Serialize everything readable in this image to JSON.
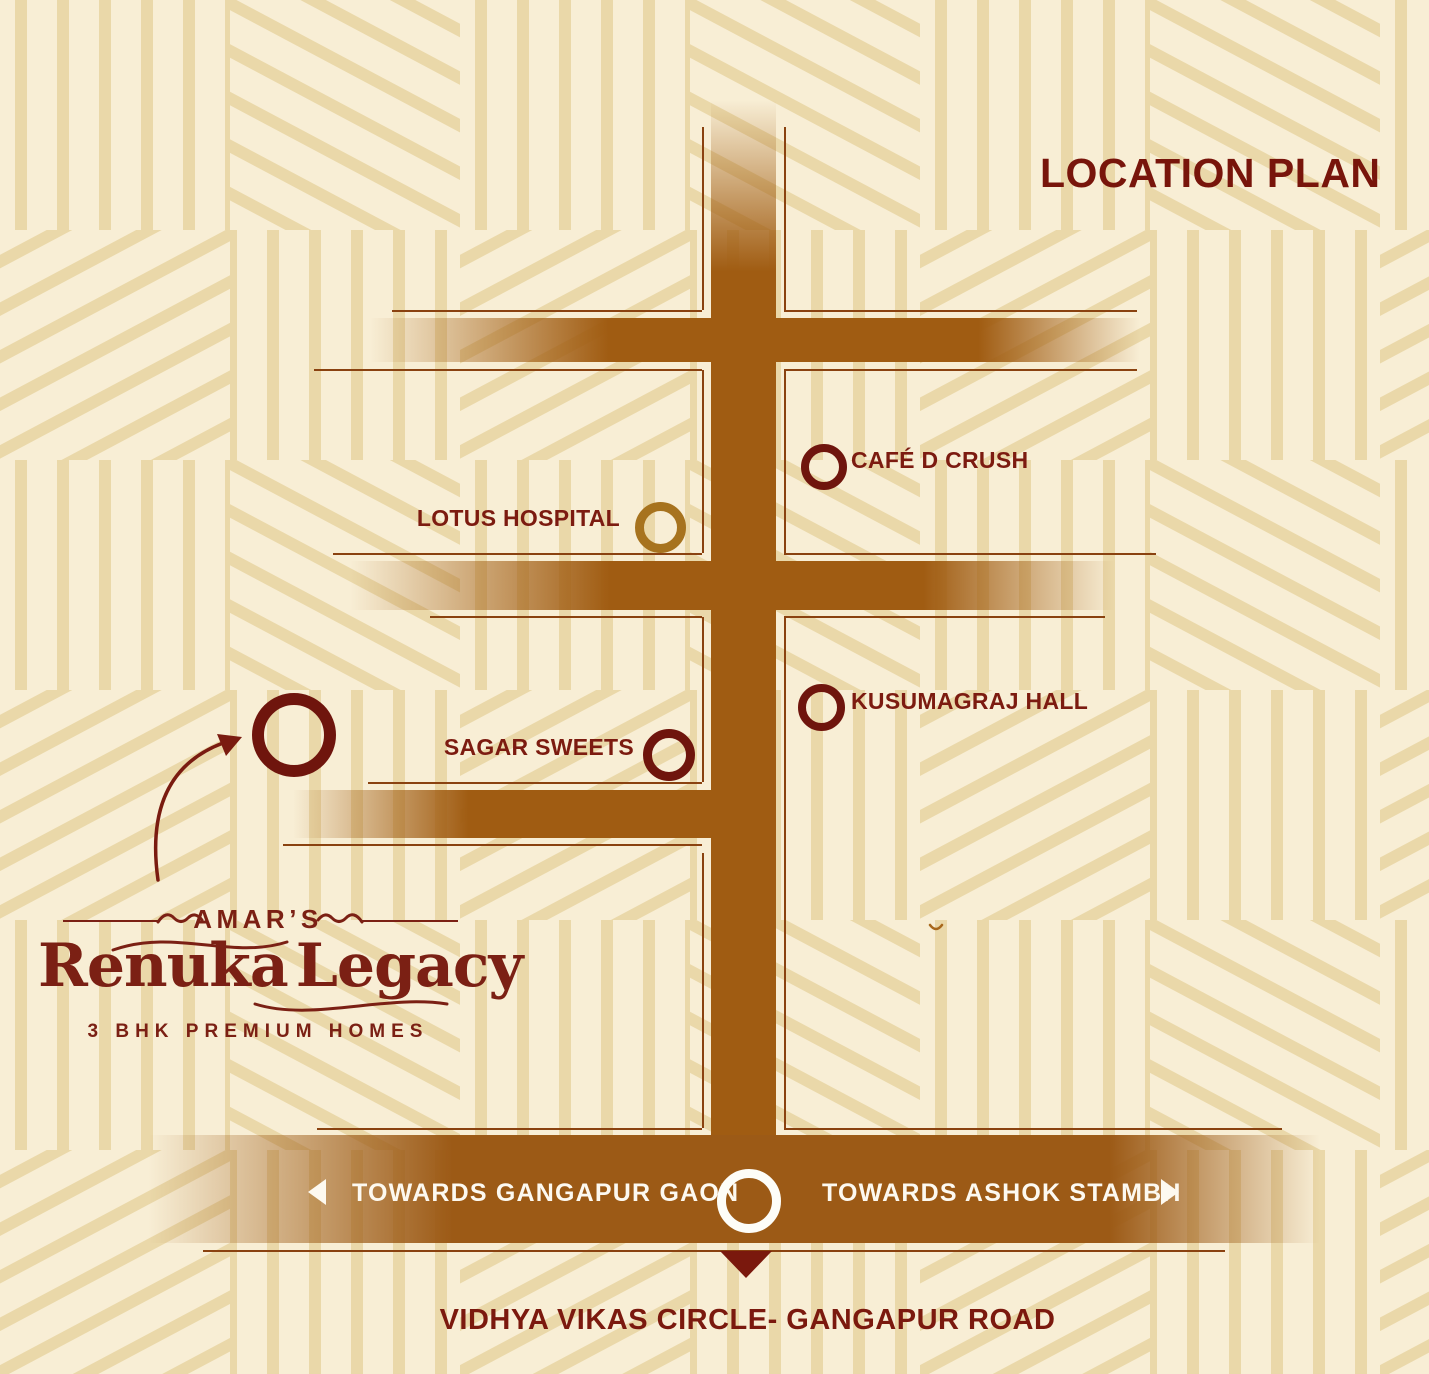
{
  "title": "LOCATION PLAN",
  "landmarks": [
    {
      "name": "CAFÉ D CRUSH",
      "marker_color": "#6f150d",
      "label_side": "right-of-marker"
    },
    {
      "name": "LOTUS HOSPITAL",
      "marker_color": "#a7731e",
      "label_side": "left-of-marker"
    },
    {
      "name": "KUSUMAGRAJ HALL",
      "marker_color": "#6f150d",
      "label_side": "right-of-marker"
    },
    {
      "name": "SAGAR SWEETS",
      "marker_color": "#6f150d",
      "label_side": "left-of-marker"
    }
  ],
  "project": {
    "brand_prefix": "AMAR’S",
    "brand_name_first": "Renuka",
    "brand_name_second": "Legacy",
    "tagline": "3 BHK PREMIUM HOMES",
    "marker_color": "#6f150d"
  },
  "bottom_road": {
    "left_direction": "TOWARDS GANGAPUR GAON",
    "right_direction": "TOWARDS ASHOK STAMBH",
    "junction_label": "VIDHYA VIKAS CIRCLE- GANGAPUR ROAD",
    "junction_marker_color": "#fdfdf8"
  },
  "icons": {
    "left_arrow": "left-direction-triangle",
    "right_arrow": "right-direction-triangle",
    "down_arrow": "junction-pointer-triangle",
    "curved_arrow": "project-location-arrow"
  },
  "colors": {
    "background_cream": "#f8eed5",
    "pattern_stripe": "#ead8a9",
    "road_brown": "#a05c12",
    "outline_brown": "#8a4210",
    "maroon_text": "#7b1b10",
    "marker_dark_maroon": "#6f150d",
    "marker_gold": "#a7731e",
    "road_text_white": "#fdf9f0"
  }
}
